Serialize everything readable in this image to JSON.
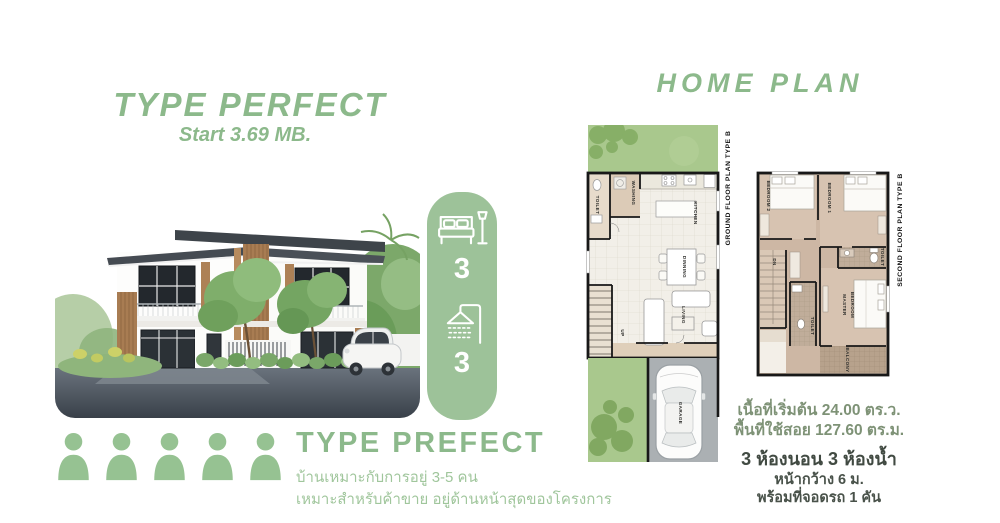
{
  "header": {
    "title": "TYPE PERFECT",
    "price": "Start 3.69 MB."
  },
  "home_plan": {
    "heading": "HOME PLAN"
  },
  "badge": {
    "bedrooms": "3",
    "bathrooms": "3",
    "color": "#9dc299"
  },
  "occupancy": {
    "count": 5,
    "icon": "person"
  },
  "type_block": {
    "title": "TYPE PREFECT",
    "line1": "บ้านเหมาะกับการอยู่ 3-5 คน",
    "line2": "เหมาะสำหรับค้าขาย อยู่ด้านหน้าสุดของโครงการ"
  },
  "plans": {
    "ground": {
      "title": "GROUND FLOOR PLAN TYPE B",
      "rooms": {
        "washing": "WASHING",
        "toilet": "TOILET",
        "kitchen": "KITCHEN",
        "dinning": "DINNING",
        "living": "LIVING",
        "up": "UP",
        "garage": "GARAGE"
      }
    },
    "second": {
      "title": "SECOND FLOOR PLAN TYPE B",
      "rooms": {
        "bedroom2": "BEDROOM 2",
        "bedroom1": "BEDROOM 1",
        "dn": "DN",
        "toilet_top": "TOILET",
        "master_line1": "MASTER",
        "master_line2": "BEDROOM",
        "toilet_bottom": "TOILET",
        "balcony": "BALCONY"
      }
    }
  },
  "specs": {
    "land_area": "เนื้อที่เริ่มต้น 24.00 ตร.ว.",
    "usable_area": "พื้นที่ใช้สอย 127.60  ตร.ม.",
    "rooms_summary": "3 ห้องนอน 3 ห้องน้ำ",
    "frontage": "หน้ากว้าง  6 ม.",
    "parking": "พร้อมที่จอดรถ 1 คัน"
  },
  "colors": {
    "accent_green": "#8cb98b",
    "badge_green": "#9dc299",
    "light_green_text": "#a0c69c",
    "olive_text": "#7e9276",
    "dark_text": "#49524a"
  }
}
